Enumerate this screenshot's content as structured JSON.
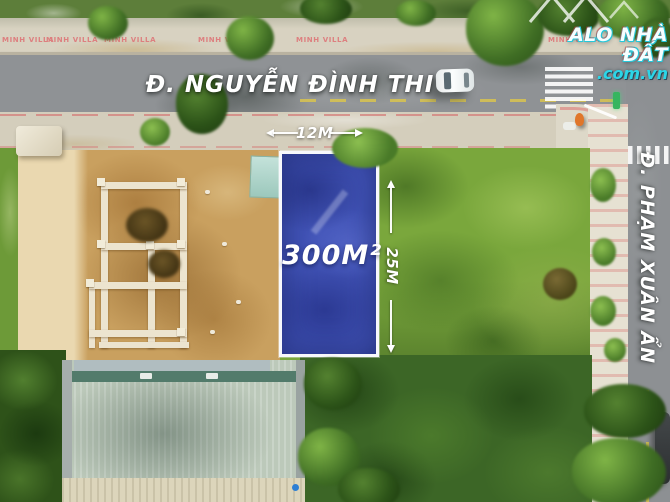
{
  "brand": {
    "name": "ALO NHÀ ĐẤT",
    "domain": ".com.vn",
    "accent_color": "#2bd6e8",
    "shadow_color": "#c43e3c",
    "logo_mark": "mountain-zigzag"
  },
  "streets": {
    "horizontal_name": "Đ. NGUYỄN ĐÌNH THI",
    "vertical_name": "Đ. PHẠM XUÂN ẨN"
  },
  "listing": {
    "area_label": "300M²",
    "frontage_label": "12M",
    "depth_label": "25M",
    "plot_fill": "#4153b6",
    "plot_border": "#ffffff"
  },
  "surroundings": {
    "villa_sign": "MINH VILLA",
    "villa_sign_color": "#dd7f7f"
  }
}
